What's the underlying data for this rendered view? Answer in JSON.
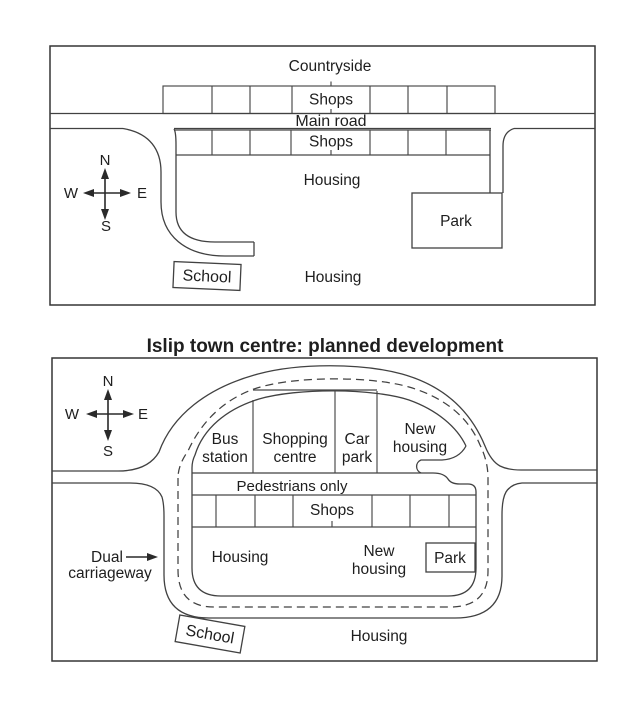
{
  "colors": {
    "ink": "#414141",
    "text": "#1e1e1e",
    "paper": "#ffffff"
  },
  "map_now": {
    "title": "Islip town centre now",
    "labels": {
      "countryside": "Countryside",
      "shops_top": "Shops",
      "main_road": "Main road",
      "shops_lower": "Shops",
      "housing_mid": "Housing",
      "housing_south": "Housing",
      "park": "Park",
      "school": "School"
    },
    "compass": {
      "n": "N",
      "s": "S",
      "e": "E",
      "w": "W"
    }
  },
  "map_planned": {
    "title": "Islip town centre: planned development",
    "labels": {
      "bus_line1": "Bus",
      "bus_line2": "station",
      "shopping_line1": "Shopping",
      "shopping_line2": "centre",
      "carpark_line1": "Car",
      "carpark_line2": "park",
      "new_housing_ne_line1": "New",
      "new_housing_ne_line2": "housing",
      "pedestrians": "Pedestrians only",
      "shops": "Shops",
      "housing_west": "Housing",
      "new_housing_s_line1": "New",
      "new_housing_s_line2": "housing",
      "park": "Park",
      "housing_south": "Housing",
      "school": "School",
      "dual_line1": "Dual",
      "dual_line2": "carriageway"
    },
    "compass": {
      "n": "N",
      "s": "S",
      "e": "E",
      "w": "W"
    }
  }
}
